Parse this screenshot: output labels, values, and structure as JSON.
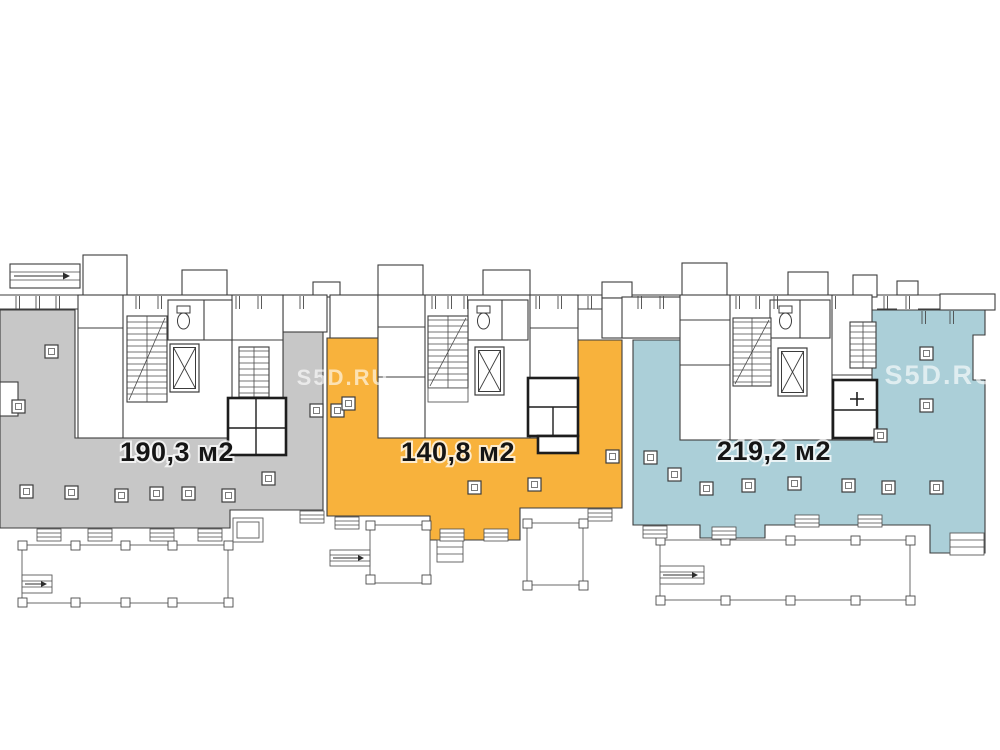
{
  "page": {
    "background": "#ffffff"
  },
  "plan": {
    "line_color": "#3c3c3c",
    "label_color": "#151515",
    "units": [
      {
        "id": "left",
        "area_label": "190,3 м2",
        "fill": "#c7c7c7"
      },
      {
        "id": "middle",
        "area_label": "140,8 м2",
        "fill": "#f8b23c"
      },
      {
        "id": "right",
        "area_label": "219,2 м2",
        "fill": "#abcfd8"
      }
    ],
    "watermarks": [
      {
        "text": "S5D.RU"
      },
      {
        "text": "S5D.RU"
      }
    ]
  }
}
